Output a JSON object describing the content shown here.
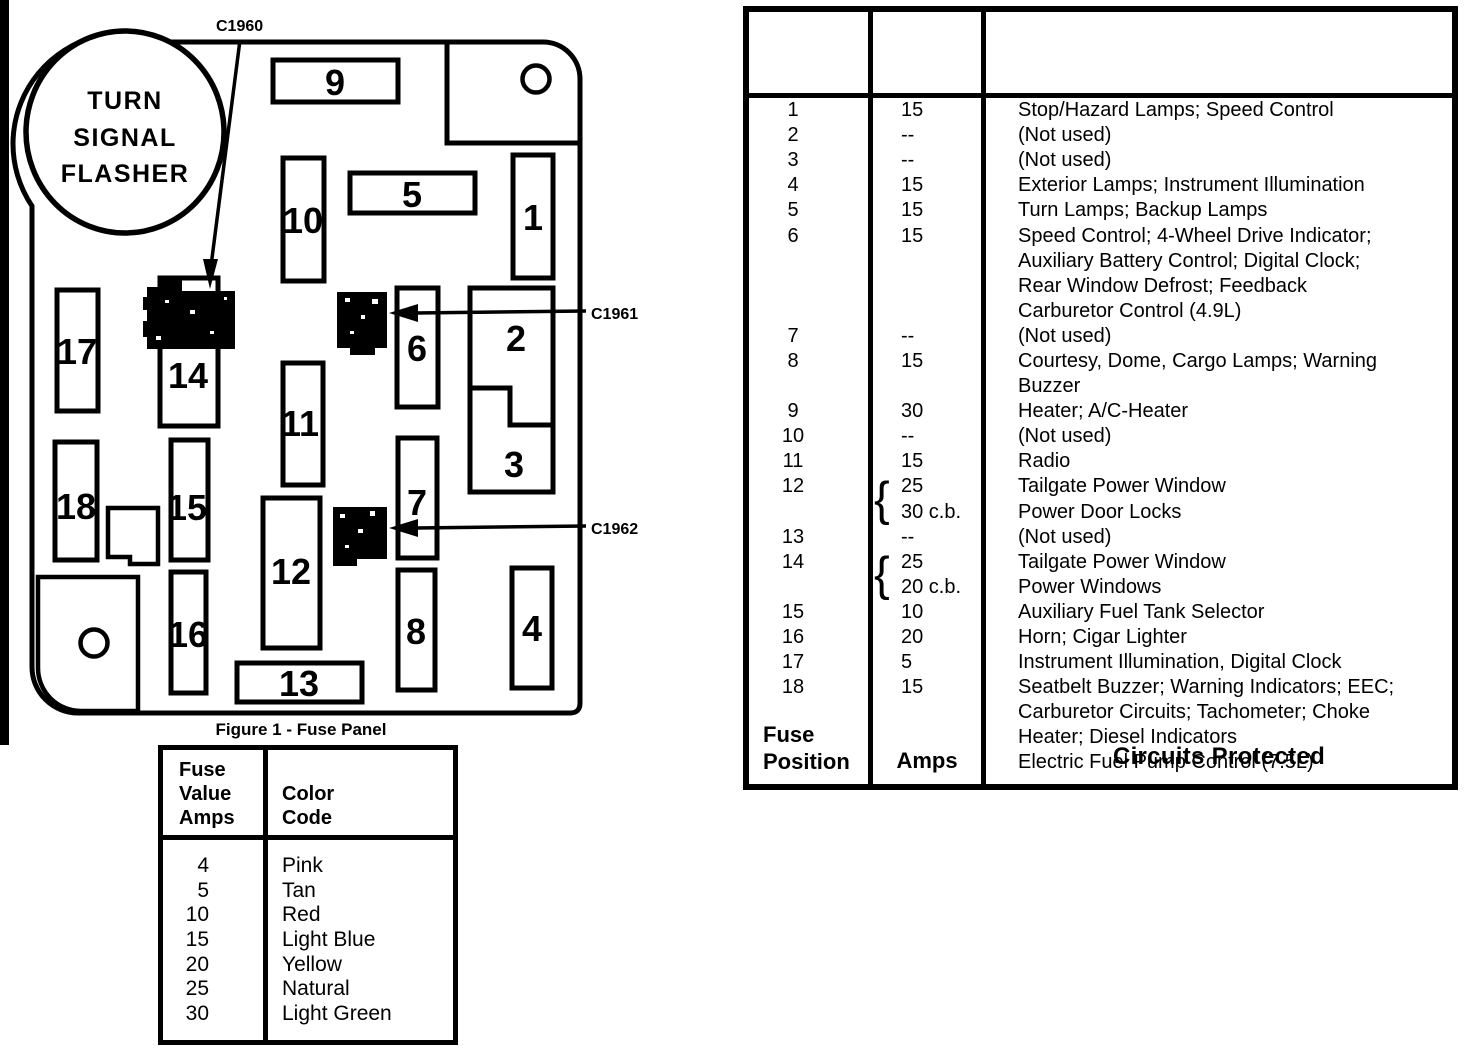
{
  "panel": {
    "flasher_lines": [
      "TURN",
      "SIGNAL",
      "FLASHER"
    ],
    "caption": "Figure 1 - Fuse Panel",
    "connectors": {
      "c1960": "C1960",
      "c1961": "C1961",
      "c1962": "C1962"
    },
    "fuses": [
      "1",
      "2",
      "3",
      "4",
      "5",
      "6",
      "7",
      "8",
      "9",
      "10",
      "11",
      "12",
      "13",
      "14",
      "15",
      "16",
      "17",
      "18"
    ]
  },
  "color_table": {
    "header_left_lines": [
      "Fuse",
      "Value",
      "Amps"
    ],
    "header_right_lines": [
      "Color",
      "Code"
    ],
    "rows": [
      {
        "amps": "4",
        "color": "Pink"
      },
      {
        "amps": "5",
        "color": "Tan"
      },
      {
        "amps": "10",
        "color": "Red"
      },
      {
        "amps": "15",
        "color": "Light Blue"
      },
      {
        "amps": "20",
        "color": "Yellow"
      },
      {
        "amps": "25",
        "color": "Natural"
      },
      {
        "amps": "30",
        "color": "Light Green"
      }
    ]
  },
  "fuse_table": {
    "header_position_lines": [
      "Fuse",
      "Position"
    ],
    "header_amps": "Amps",
    "header_circuits": "Circuits Protected",
    "brace_glyph": "{",
    "lines": [
      {
        "pos": "1",
        "amps": "15",
        "circuit": "Stop/Hazard Lamps; Speed Control"
      },
      {
        "pos": "2",
        "amps": "--",
        "circuit": "(Not used)"
      },
      {
        "pos": "3",
        "amps": "--",
        "circuit": "(Not used)"
      },
      {
        "pos": "4",
        "amps": "15",
        "circuit": "Exterior Lamps; Instrument Illumination"
      },
      {
        "pos": "5",
        "amps": "15",
        "circuit": "Turn Lamps; Backup Lamps"
      },
      {
        "pos": "6",
        "amps": "15",
        "circuit": "Speed Control; 4-Wheel Drive Indicator;"
      },
      {
        "pos": "",
        "amps": "",
        "circuit": "Auxiliary Battery Control; Digital Clock;"
      },
      {
        "pos": "",
        "amps": "",
        "circuit": "Rear Window Defrost; Feedback"
      },
      {
        "pos": "",
        "amps": "",
        "circuit": "Carburetor Control (4.9L)"
      },
      {
        "pos": "7",
        "amps": "--",
        "circuit": "(Not used)"
      },
      {
        "pos": "8",
        "amps": "15",
        "circuit": "Courtesy, Dome, Cargo Lamps; Warning"
      },
      {
        "pos": "",
        "amps": "",
        "circuit": "Buzzer"
      },
      {
        "pos": "9",
        "amps": "30",
        "circuit": "Heater; A/C-Heater"
      },
      {
        "pos": "10",
        "amps": "--",
        "circuit": "(Not used)"
      },
      {
        "pos": "11",
        "amps": "15",
        "circuit": "Radio"
      },
      {
        "pos": "12",
        "amps": "25",
        "circuit": "Tailgate Power Window",
        "brace": true
      },
      {
        "pos": "",
        "amps": "30 c.b.",
        "circuit": "Power Door Locks"
      },
      {
        "pos": "13",
        "amps": "--",
        "circuit": "(Not used)"
      },
      {
        "pos": "14",
        "amps": "25",
        "circuit": "Tailgate Power Window",
        "brace": true
      },
      {
        "pos": "",
        "amps": "20 c.b.",
        "circuit": "Power Windows"
      },
      {
        "pos": "15",
        "amps": "10",
        "circuit": "Auxiliary Fuel Tank Selector"
      },
      {
        "pos": "16",
        "amps": "20",
        "circuit": "Horn; Cigar Lighter"
      },
      {
        "pos": "17",
        "amps": "5",
        "circuit": "Instrument Illumination, Digital Clock"
      },
      {
        "pos": "18",
        "amps": "15",
        "circuit": "Seatbelt Buzzer; Warning Indicators; EEC;"
      },
      {
        "pos": "",
        "amps": "",
        "circuit": "Carburetor Circuits; Tachometer; Choke"
      },
      {
        "pos": "",
        "amps": "",
        "circuit": "Heater; Diesel Indicators"
      },
      {
        "pos": "",
        "amps": "",
        "circuit": "Electric Fuel Pump Control (7.5L)"
      }
    ]
  },
  "colors": {
    "ink": "#000000",
    "paper": "#ffffff"
  }
}
